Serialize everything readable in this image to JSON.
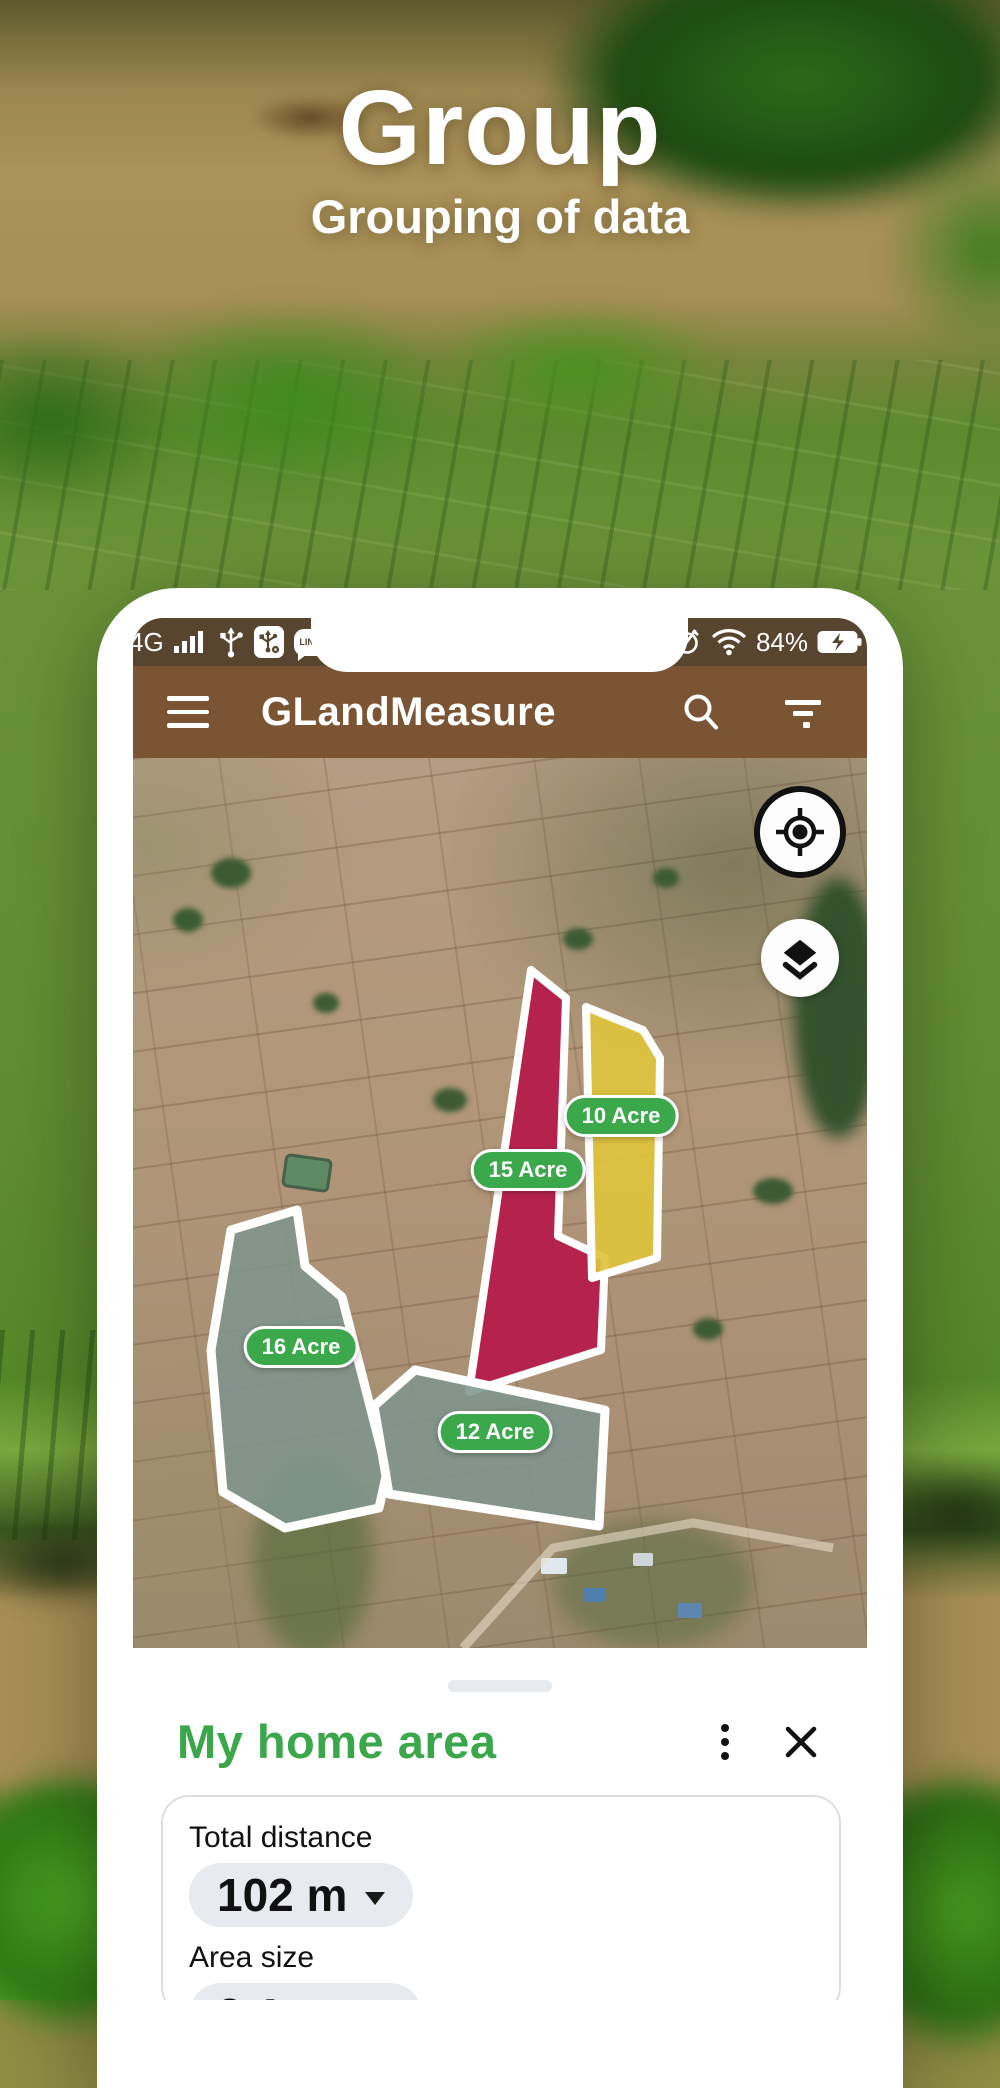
{
  "hero": {
    "title": "Group",
    "subtitle": "Grouping of data"
  },
  "phone": {
    "status_bar": {
      "network": "4G",
      "battery_percent": "84%",
      "line_app_label": "LINE"
    },
    "app_bar": {
      "title": "GLandMeasure"
    },
    "map": {
      "parcels": [
        {
          "label": "10 Acre",
          "color": "#dfc33d"
        },
        {
          "label": "15 Acre",
          "color": "#b5224d"
        },
        {
          "label": "16 Acre",
          "color": "#80958d"
        },
        {
          "label": "12 Acre",
          "color": "#80958d"
        }
      ],
      "label_bg": "#3aa84b"
    },
    "bottom_sheet": {
      "title": "My home area",
      "title_color": "#3aa74a",
      "fields": [
        {
          "label": "Total distance",
          "value": "102 m"
        },
        {
          "label": "Area size",
          "value": "2 Acre"
        }
      ]
    }
  },
  "colors": {
    "app_bar_brown": "#7a5433",
    "status_bar_brown": "#58452f",
    "parcel_label_green": "#3aa84b"
  }
}
